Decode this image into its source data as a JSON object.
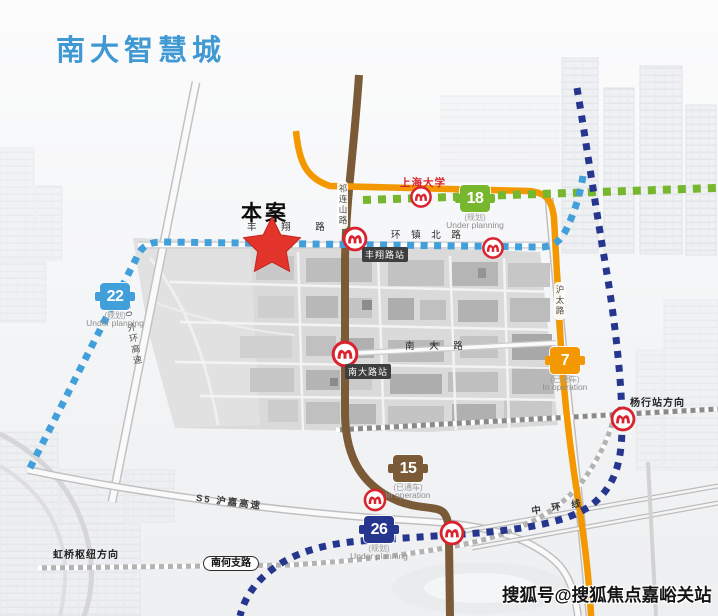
{
  "title": "南大智慧城",
  "marker": {
    "label": "本案"
  },
  "watermark": "搜狐号@搜狐焦点嘉峪关站",
  "colors": {
    "title": "#4199d4",
    "line-7": "#f39800",
    "line-15": "#7b5a38",
    "line-18": "#76b72e",
    "line-22": "#41a0da",
    "line-26": "#26368f",
    "station-red": "#d9232e",
    "star": "#e2342b"
  },
  "metro_lines": [
    {
      "number": "18",
      "status_cn": "(规划)",
      "status_en": "Under planning"
    },
    {
      "number": "22",
      "status_cn": "(规划)",
      "status_en": "Under planning"
    },
    {
      "number": "7",
      "status_cn": "(已通车)",
      "status_en": "In operation"
    },
    {
      "number": "15",
      "status_cn": "(已通车)",
      "status_en": "In operation"
    },
    {
      "number": "26",
      "status_cn": "(规划)",
      "status_en": "Under planning"
    }
  ],
  "stations": {
    "shanghai_university": "上海大学",
    "fengxiang_road": "丰翔路站",
    "nanda_road": "南大路站"
  },
  "directions": {
    "yanghang": "杨行站方向",
    "hongqiao": "虹桥枢纽方向"
  },
  "roads": {
    "fengxiang": "丰 翔 路",
    "huanzhen_north": "环 镇 北 路",
    "qilianshan": "祁连山路",
    "hutai": "沪太路",
    "nanda": "南 大 路",
    "s20": "S20 外环高速",
    "s5": "S5 沪嘉高速",
    "zhonghuan": "中 环 线",
    "nanhe": "南何支路"
  }
}
